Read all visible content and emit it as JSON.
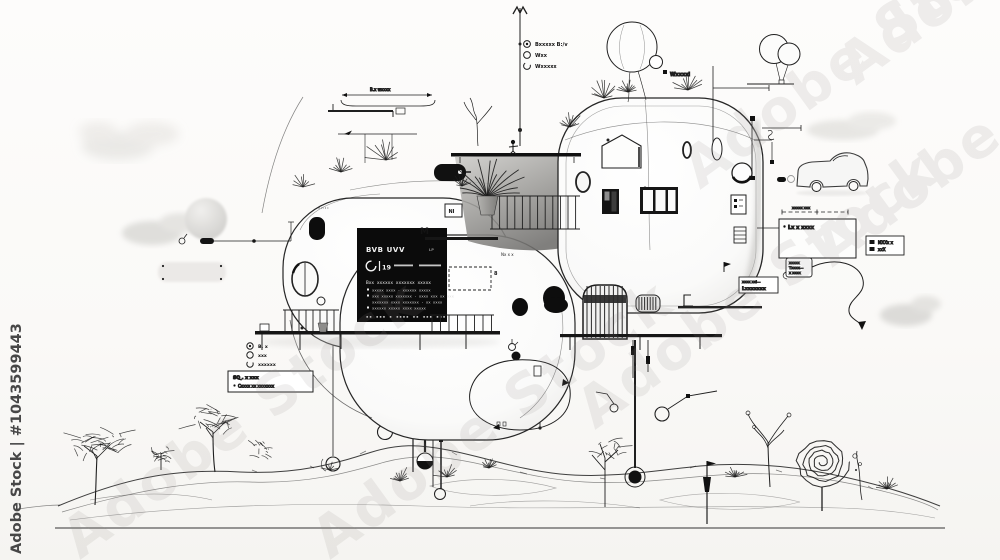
{
  "watermarks": {
    "side": "Adobe Stock | #1043599443",
    "diagonal": "Adobe Stock"
  },
  "palette": {
    "ink": "#1f1f1f",
    "paper": "#fbfaf8",
    "cloud": "#e7e6e3",
    "panel": "#0b0b0b",
    "panel_text": "#f4f4f4"
  },
  "spec_panel": {
    "title": "BVB UVV",
    "title_right": "LP",
    "stat": "19",
    "heading": "Bxx xxxxxx xxxxxxx xxxxx",
    "bullets": [
      "xxxxx xxxx · xxxxxx xxxxx",
      "xxx xxxxx xxxxxxx · xxxx xxx xx xxx",
      "xxxxxxx xxxx xxxxxxx · xx xxxx",
      "xxxxxx xxxxx xxxx xxxxx"
    ],
    "footer": "▪▪ ▪▪▪ ▪ ▪▪▪▪ ▪▪ ▪▪▪ ▪▪▪"
  },
  "callouts": {
    "top_list": [
      {
        "label": "Bxxxxx B:/v"
      },
      {
        "label": "Wxx"
      },
      {
        "label": "Wxxxxx"
      }
    ],
    "roof_label": "Wxxxxl",
    "dim_label": "B.x wxxxx",
    "dash_dim_label": "xxxxx xxx",
    "zone_label": "Lx x xxxx",
    "legend": [
      {
        "label": "MXXx x"
      },
      {
        "label": "xxX"
      }
    ],
    "note_card": [
      "xxxxx",
      "Txxxx—",
      "x xxxx"
    ],
    "note_box": [
      "xxxx xxl—",
      "Lxxxxxxx"
    ],
    "bottom_list": [
      {
        "label": "B. x"
      },
      {
        "label": "xxx"
      },
      {
        "label": "xxxxxx"
      }
    ],
    "bottom_box": [
      "SQ˯. x xxx",
      "Cxxxx xx xxxxxxx"
    ],
    "mark_m": "M",
    "mark_8": "8",
    "mark_ni": "NI",
    "deck_label": "Nx x x",
    "micro_label": "v ʜ ɪ ɪ"
  }
}
